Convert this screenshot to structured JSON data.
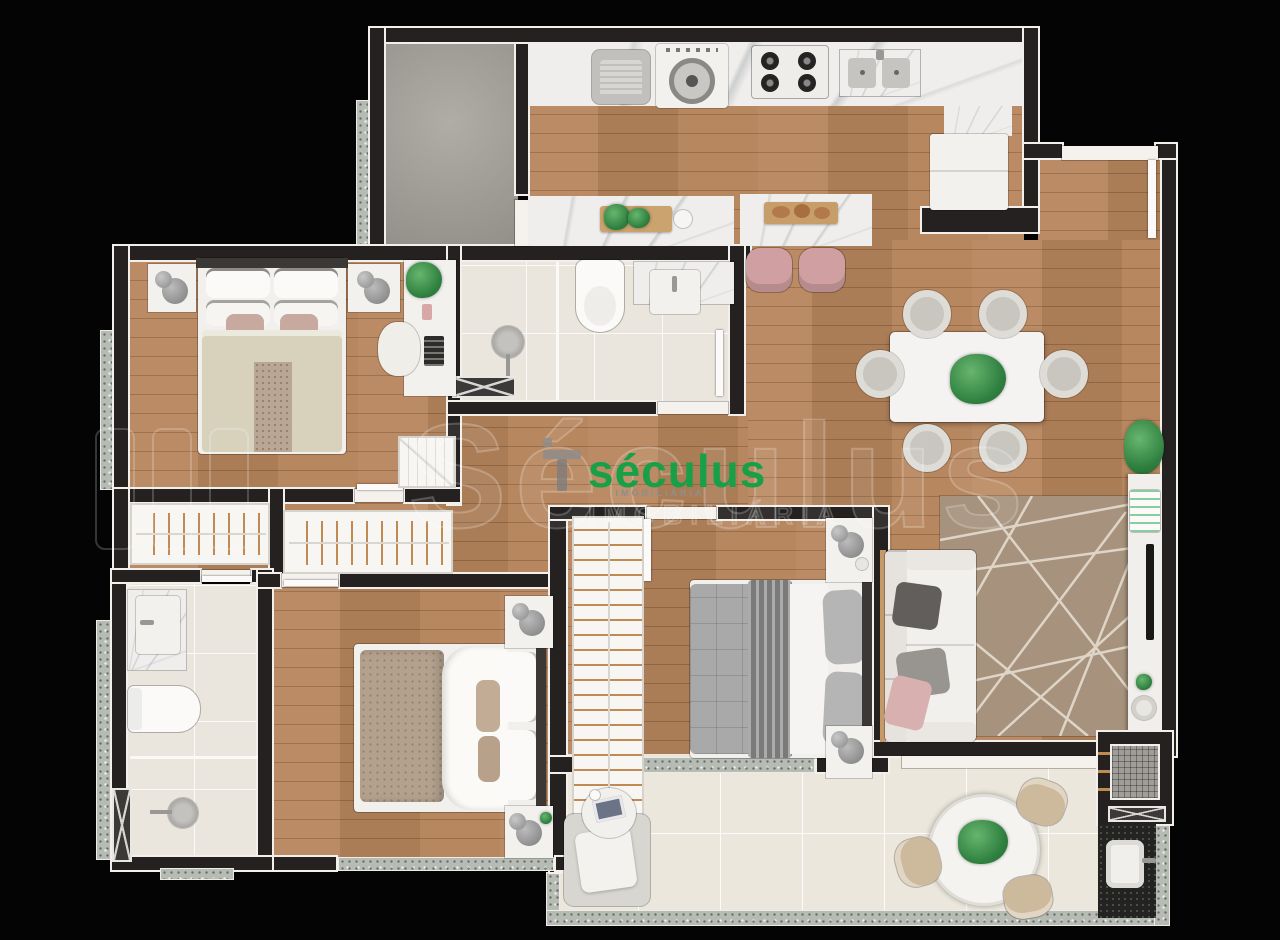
{
  "watermark": {
    "brand_outline": "Séculus",
    "outline_subtitle": "IMOBILIÁRIA",
    "logo_text": "séculus",
    "logo_subtitle": "IMOBILIÁRIA",
    "logo_color": "#17a048"
  },
  "colors": {
    "background": "#040404",
    "wall": "#242120",
    "wall_trim": "#f3f0ec",
    "wood_floor": "#b6855c",
    "marble_counter": "#f0eeec",
    "bathroom_tile": "#eae6de",
    "balcony_tile": "#ece7dc",
    "granite_sill": "#b6bcb4",
    "service_floor": "#a7a39c",
    "rug": "#a6927d",
    "accent_green": "#2f8040",
    "accent_pink": "#cf9fa1",
    "furniture_white": "#f3f1ee",
    "furniture_gray": "#a9a9a9"
  }
}
